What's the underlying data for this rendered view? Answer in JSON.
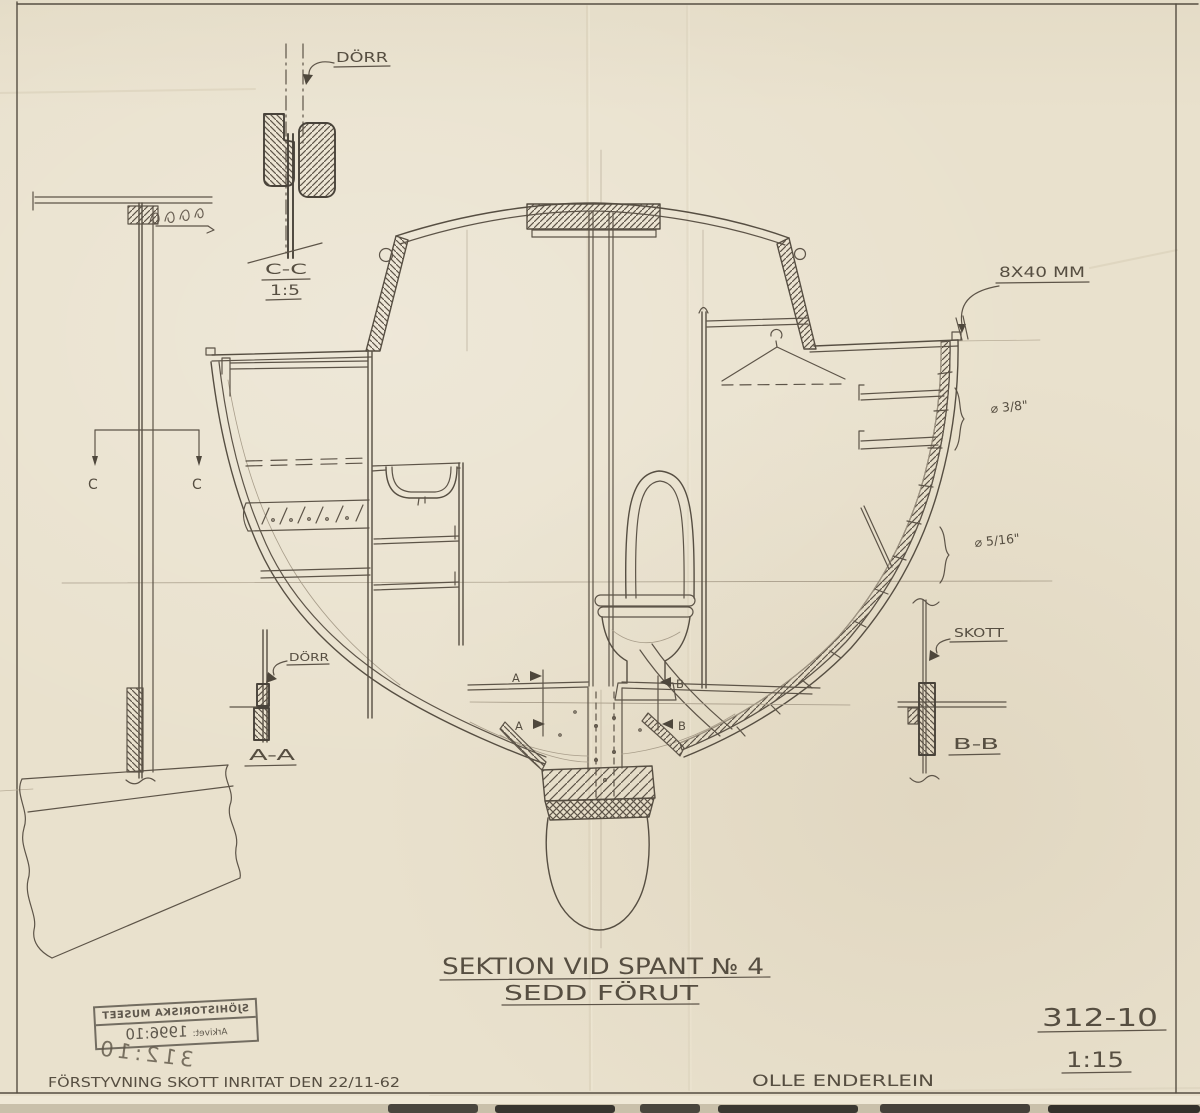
{
  "meta": {
    "document_type": "Hand-drawn yacht section drawing",
    "paper_color": "#e9e1cd",
    "pencil_color": "#5d5448"
  },
  "annotations": {
    "dorr_top": "DÖRR",
    "dorr_bottom": "DÖRR",
    "cc_label": "C-C",
    "cc_scale": "1:5",
    "aa_label": "A-A",
    "bb_label": "B-B",
    "skott": "SKOTT",
    "bolt_spec": "8X40 MM",
    "dia_upper": "⌀ 3/8\"",
    "dia_lower": "⌀ 5/16\"",
    "c_left": "C",
    "c_right": "C",
    "a_upper": "A",
    "a_lower": "A",
    "b_upper": "B",
    "b_lower": "B"
  },
  "title_block": {
    "title": "SEKTION VID SPANT № 4",
    "subtitle": "SEDD FÖRUT",
    "drawing_number": "312-10",
    "scale": "1:15"
  },
  "footer": {
    "revision_note": "FÖRSTYVNING SKOTT INRITAT DEN 22/11-62",
    "designer": "OLLE ENDERLEIN"
  },
  "stamp": {
    "museum": "SJÖHISTORISKA MUSEET",
    "archive_label": "Arkivet:",
    "archive_no": "1996:10",
    "pencil_no": "312:10"
  }
}
